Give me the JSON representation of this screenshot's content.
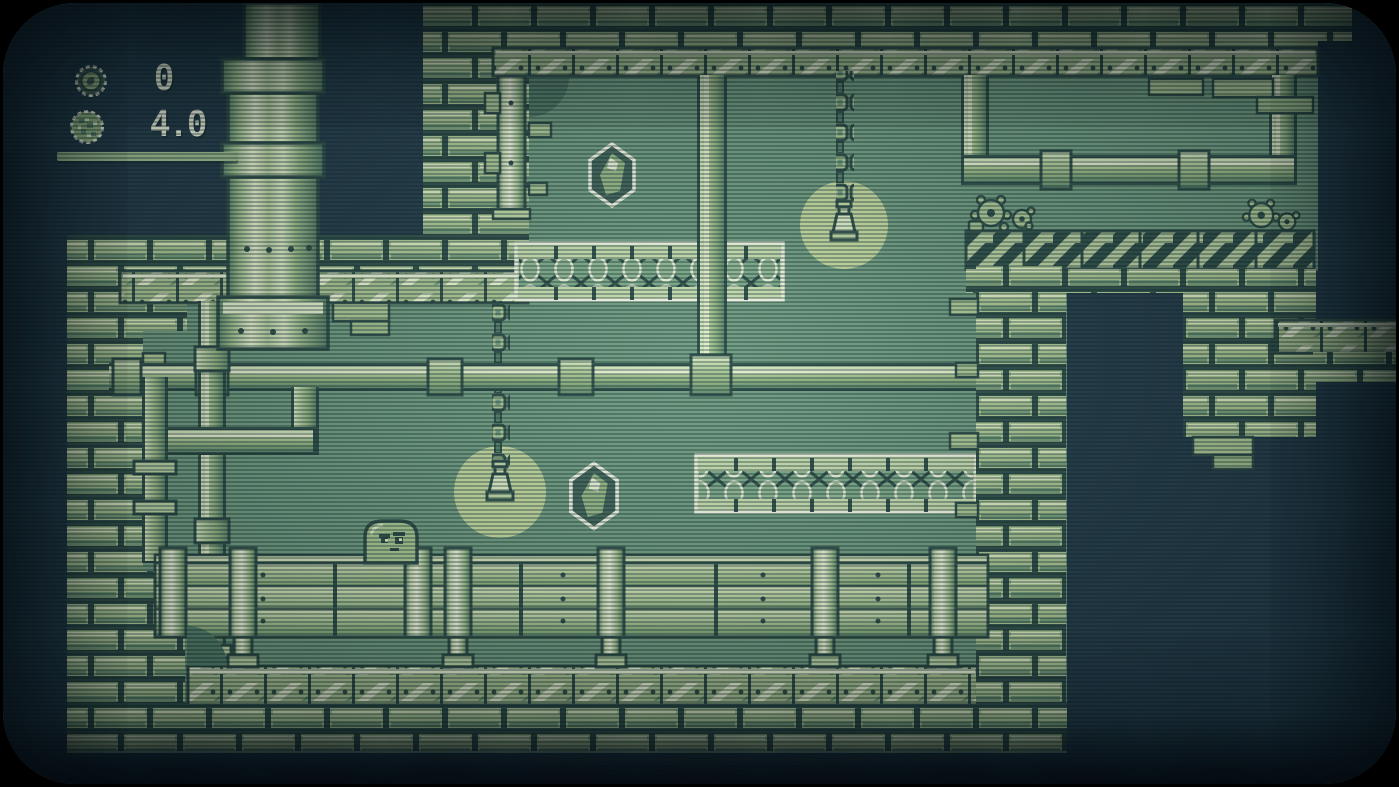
{
  "hud": {
    "coin_count": "0",
    "power_value": "4.0",
    "coin_icon": "coin-icon",
    "ball_icon": "ball-icon"
  },
  "palette": {
    "outside_dark": "#24404d",
    "room_green": "#6f9e82",
    "sprite_light": "#a9c997",
    "sprite_highlight": "#e7f5d3",
    "outline_dark": "#2f524b",
    "lamp_glow": "#bfd9a0",
    "hud_text": "#e6efd9"
  },
  "sprites": {
    "glow_upper": {
      "transform": "translate(841,222)"
    },
    "glow_lower": {
      "transform": "translate(497,489)"
    },
    "lamp_upper": {
      "transform": "translate(841,198)"
    },
    "lamp_lower": {
      "transform": "translate(497,458)"
    },
    "gem_upper": {
      "transform": "translate(609,172)"
    },
    "gem_lower": {
      "transform": "translate(591,493) scale(1.05)"
    },
    "player": {
      "transform": "translate(362,518)"
    }
  },
  "scene": {
    "style": "gameboy-monochrome-platformer",
    "gem_count": 2,
    "hanging_lamp_count": 2,
    "truss_platform_count": 2,
    "hazard_segment_count": 6,
    "rock_cluster_count": 2,
    "player_type": "slime-blob"
  }
}
